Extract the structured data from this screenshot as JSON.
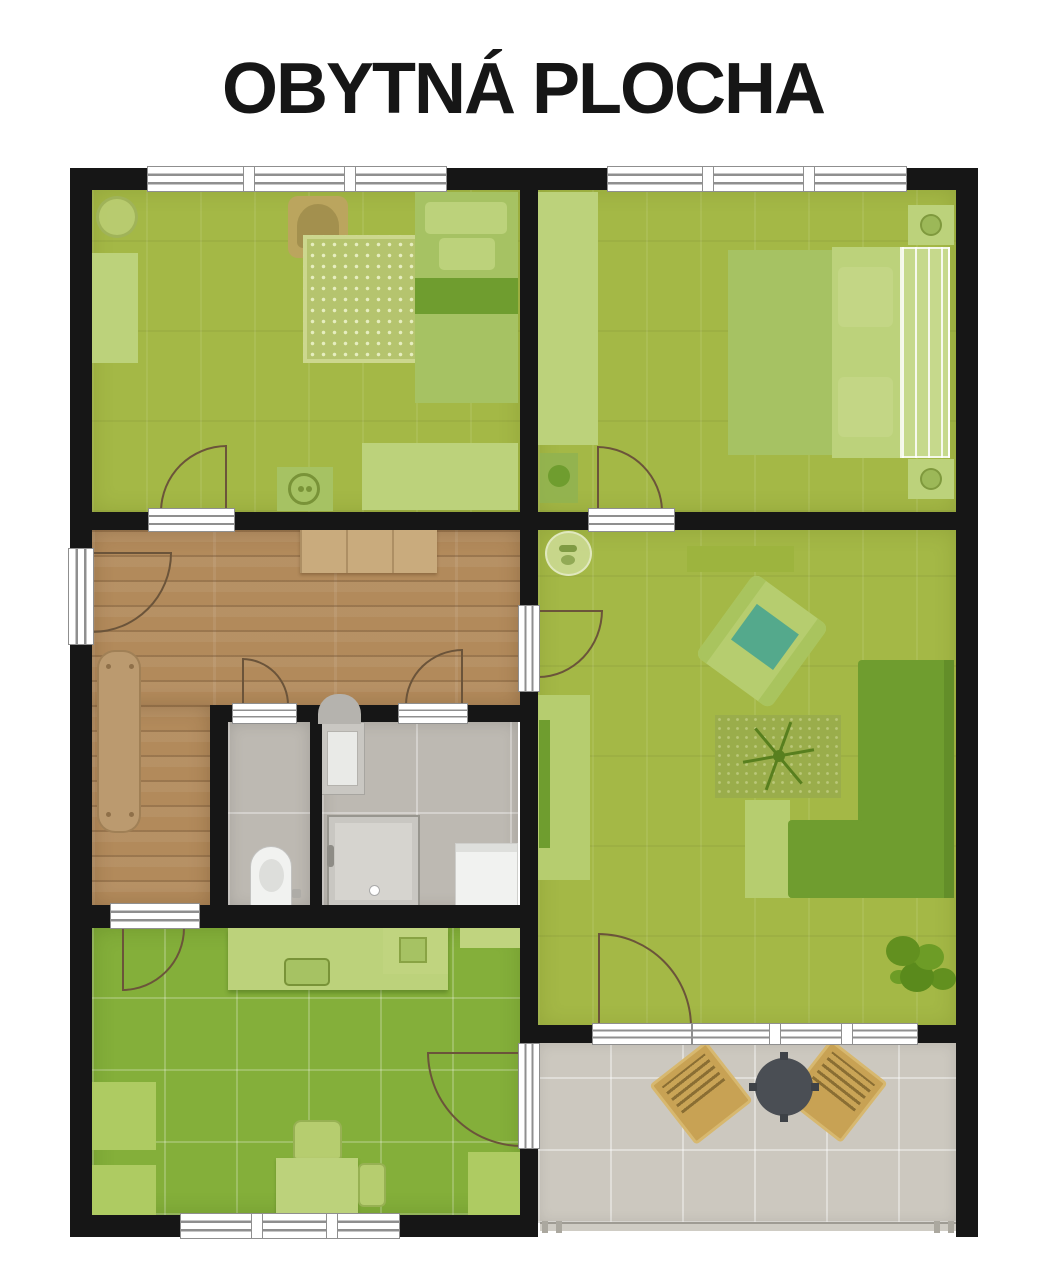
{
  "title": "OBYTNÁ PLOCHA",
  "palette": {
    "title_color": "#161616",
    "wall": "#161616",
    "frame_line": "#8f8f8f",
    "arc": "#6b543a",
    "floor_wood_green": "#a4b846",
    "floor_tile_green": "#84af3a",
    "floor_hall_wood": "#b28a5b",
    "floor_tile_gray": "#bdb9b2",
    "floor_tile_terrace": "#ccc8bf",
    "furniture_light": "#bcd27b",
    "furniture_mid": "#a6c263",
    "furniture_dark": "#6f9d2f",
    "rug": "#b5c46e",
    "wood_furniture": "#c9ab7d",
    "bench_wood": "#bb9a6f",
    "tan_chair": "#bba55e",
    "teal": "#54a98c",
    "fixture_white": "#f1f2f0",
    "fixture_gray": "#c9c7c2",
    "terrace_chair": "#c8a254",
    "terrace_table": "#4a4e54",
    "railing": "#cfccc4"
  },
  "rooms": [
    {
      "id": "bedroom-1",
      "surface": "green wood"
    },
    {
      "id": "bedroom-2",
      "surface": "green wood"
    },
    {
      "id": "living-room",
      "surface": "green wood"
    },
    {
      "id": "hallway",
      "surface": "wood parquet"
    },
    {
      "id": "wc",
      "surface": "gray tile"
    },
    {
      "id": "bathroom",
      "surface": "gray tile"
    },
    {
      "id": "kitchen",
      "surface": "green tile"
    },
    {
      "id": "terrace",
      "surface": "beige tile"
    }
  ]
}
